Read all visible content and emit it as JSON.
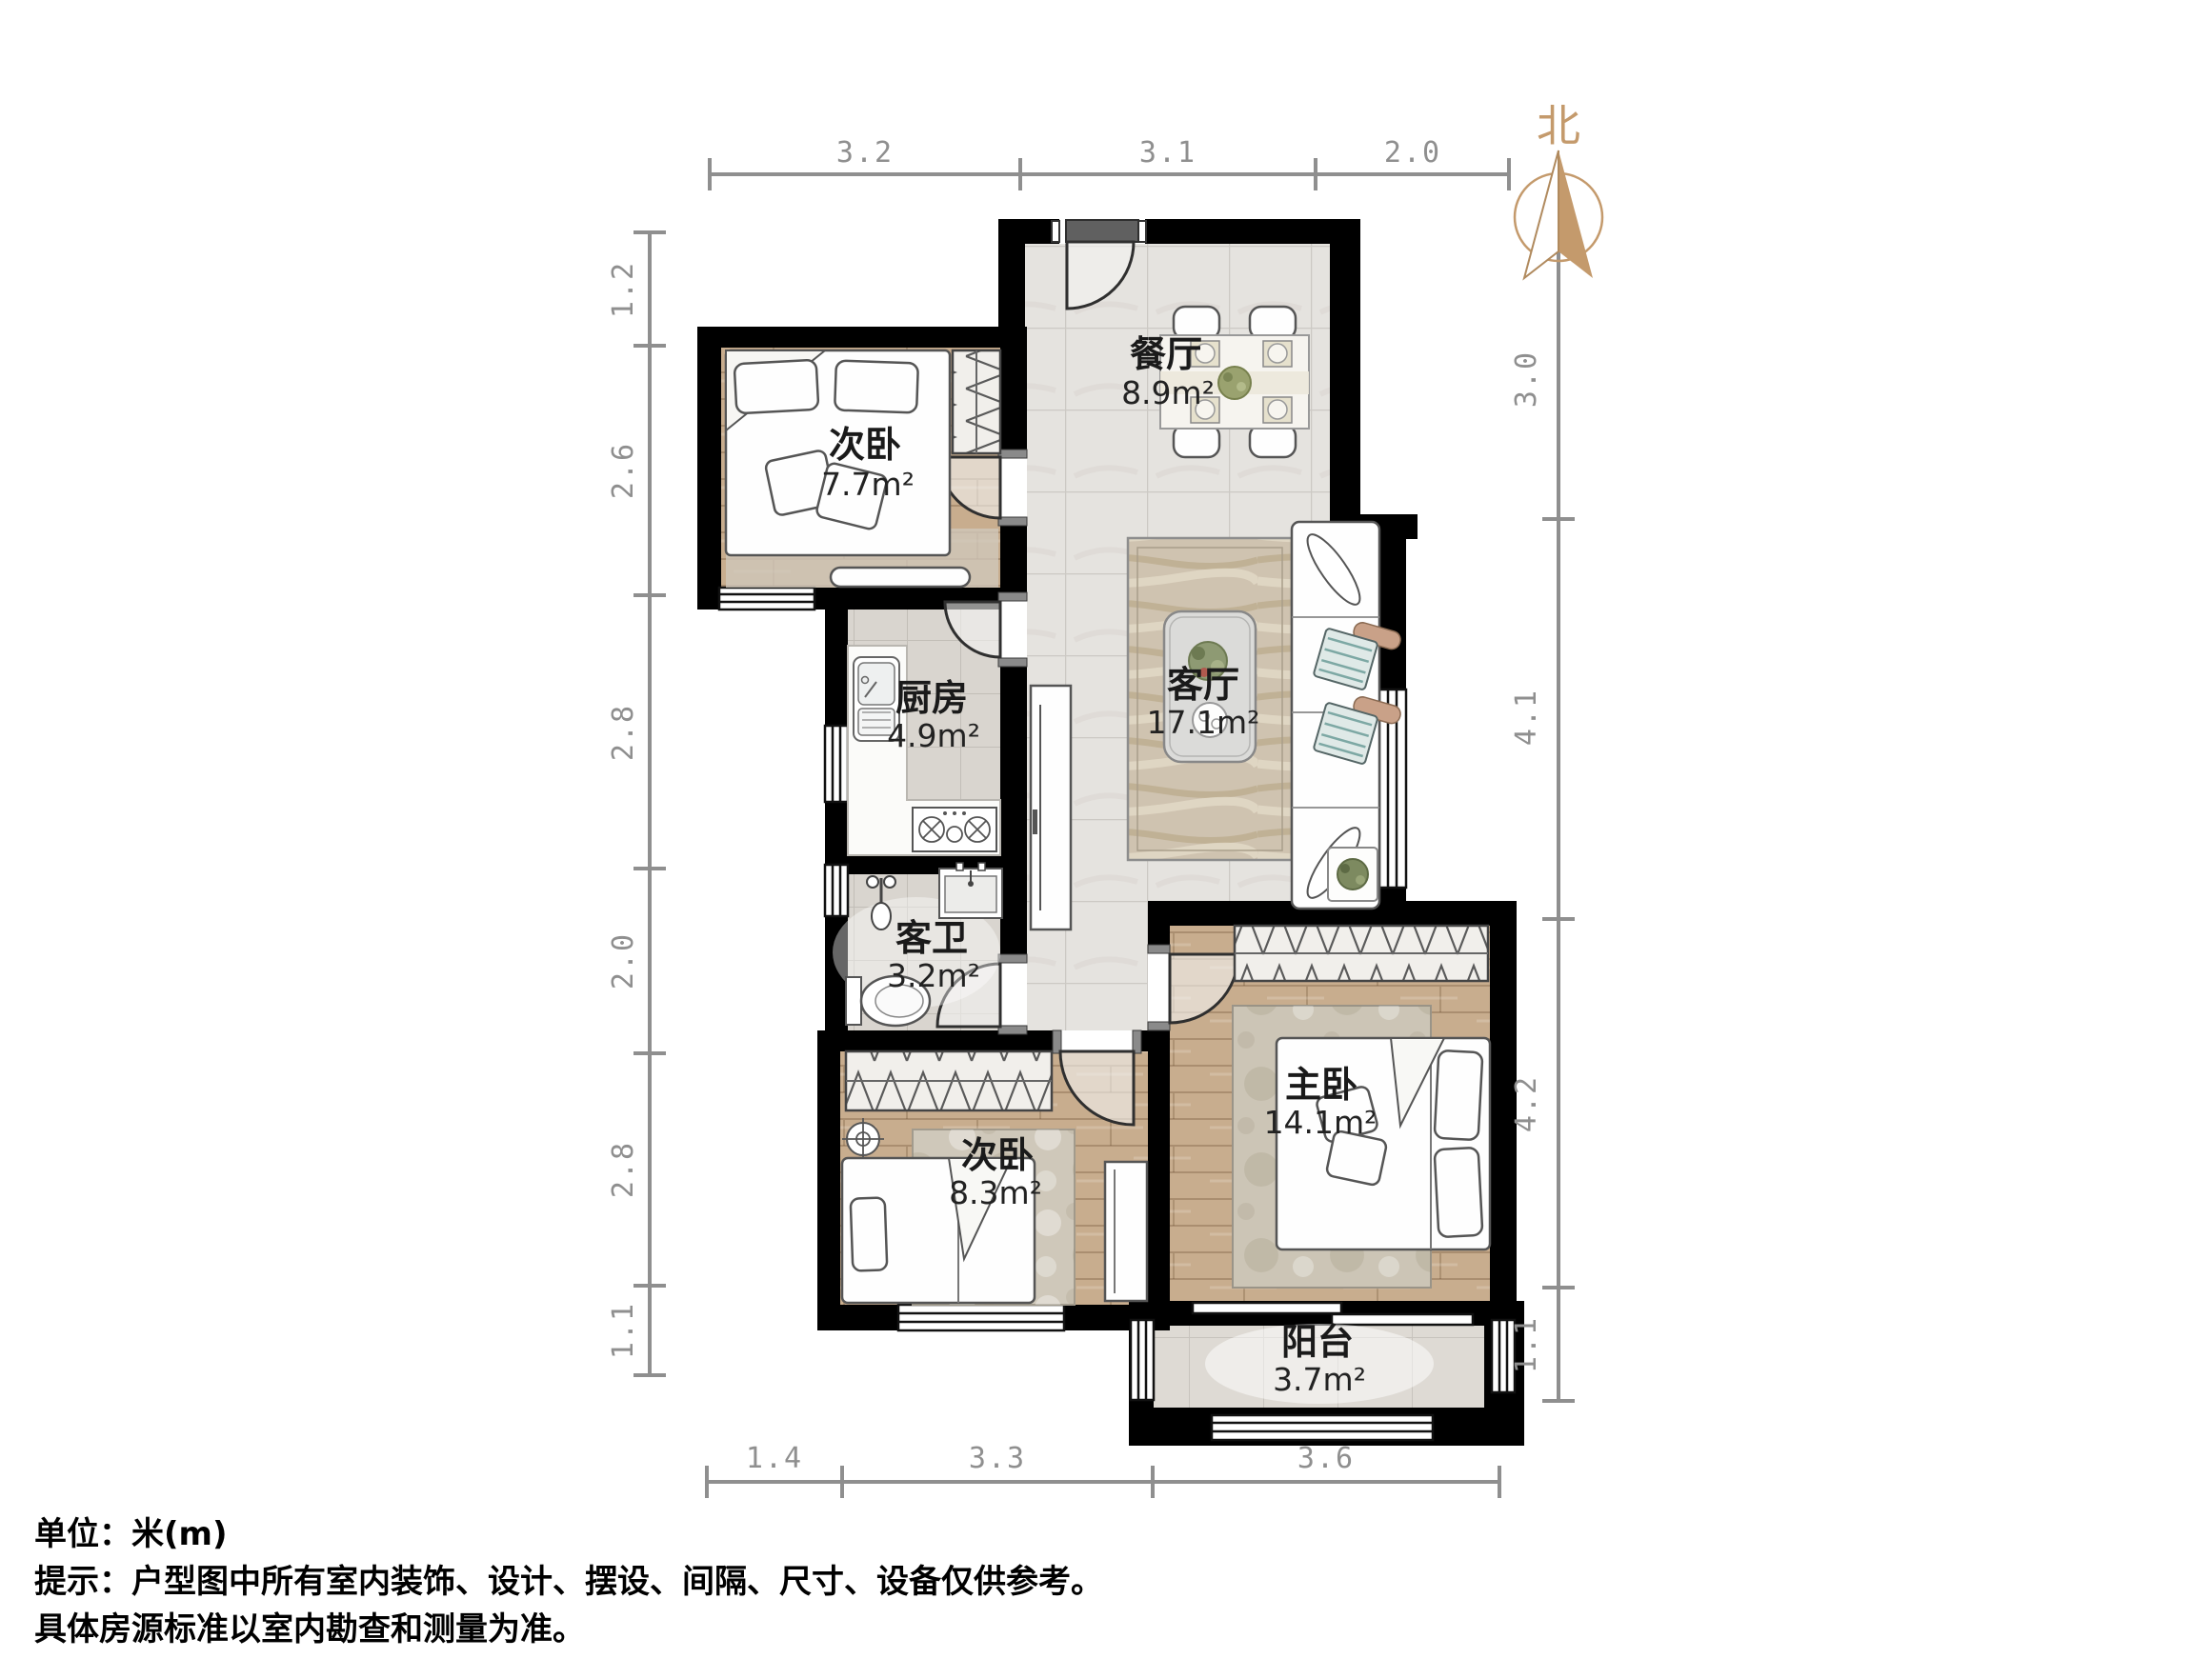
{
  "north": {
    "label": "北"
  },
  "rooms": {
    "bedroom_top": {
      "name": "次卧",
      "area": "7.7m²"
    },
    "dining": {
      "name": "餐厅",
      "area": "8.9m²"
    },
    "kitchen": {
      "name": "厨房",
      "area": "4.9m²"
    },
    "living": {
      "name": "客厅",
      "area": "17.1m²"
    },
    "bath": {
      "name": "客卫",
      "area": "3.2m²"
    },
    "bedroom_bottom": {
      "name": "次卧",
      "area": "8.3m²"
    },
    "master": {
      "name": "主卧",
      "area": "14.1m²"
    },
    "balcony": {
      "name": "阳台",
      "area": "3.7m²"
    }
  },
  "dimensions": {
    "top": [
      "3.2",
      "3.1",
      "2.0"
    ],
    "bottom": [
      "1.4",
      "3.3",
      "3.6"
    ],
    "left": [
      "1.2",
      "2.6",
      "2.8",
      "2.0",
      "2.8",
      "1.1"
    ],
    "right": [
      "3.0",
      "4.1",
      "4.2",
      "1.1"
    ]
  },
  "footer": {
    "unit_line": "单位：米(m)",
    "hint_line1": "提示：户型图中所有室内装饰、设计、摆设、间隔、尺寸、设备仅供参考。",
    "hint_line2": "具体房源标准以室内勘查和测量为准。"
  },
  "colors": {
    "wall": "#000000",
    "dimension": "#8f8f8f",
    "north": "#c49a6c",
    "label": "#1a1a1a",
    "wood_floor": "#c8ad8e",
    "tile_floor": "#e5e3df"
  }
}
